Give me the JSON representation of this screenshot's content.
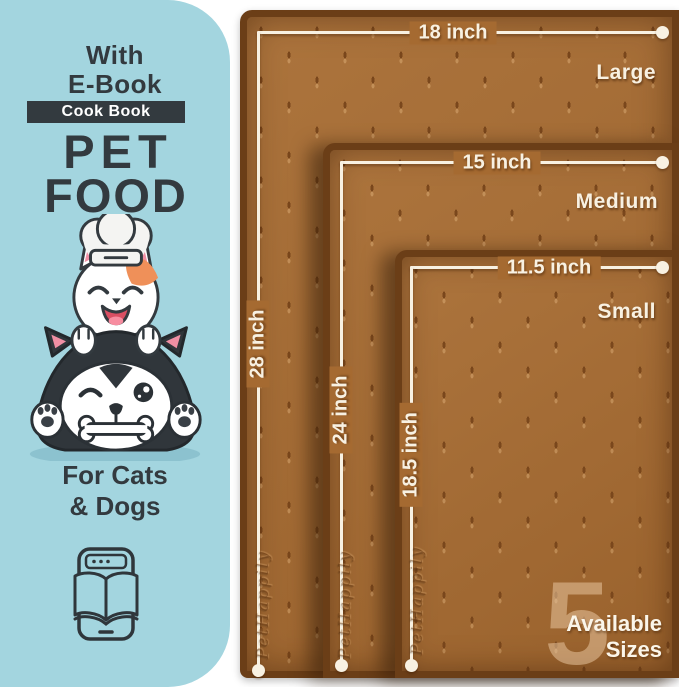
{
  "sidebar": {
    "ebook_note_line1": "With",
    "ebook_note_line2": "E-Book",
    "banner_label": "Cook Book",
    "title_line1": "PET",
    "title_line2": "FOOD",
    "audience_line1": "For Cats",
    "audience_line2": "& Dogs"
  },
  "mats": {
    "sizes": [
      {
        "name": "Large",
        "width": "18 inch",
        "height": "28 inch"
      },
      {
        "name": "Medium",
        "width": "15 inch",
        "height": "24 inch"
      },
      {
        "name": "Small",
        "width": "11.5 inch",
        "height": "18.5 inch"
      }
    ],
    "watermark": "PetHappily",
    "badge_count": "5",
    "badge_line1": "Available",
    "badge_line2": "Sizes"
  },
  "colors": {
    "sidebar_bg": "#a3d5df",
    "ink": "#333a3f",
    "mat_surface": "#a56a31",
    "mat_rim": "#6b3e17",
    "dimension_cream": "#f8f1e2",
    "badge_tint": "#e7c59e"
  }
}
